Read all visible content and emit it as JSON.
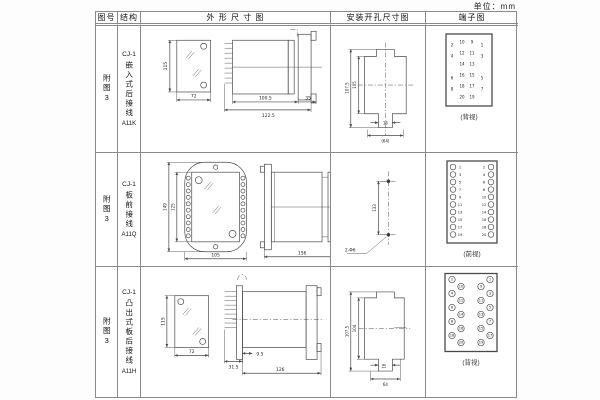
{
  "unit_label": "单位：mm",
  "header": {
    "fig": "图号",
    "structure": "结构",
    "outline": "外 形 尺 寸 图",
    "install": "安装开孔尺寸图",
    "terminal": "端子图"
  },
  "rows": [
    {
      "fig": "附图3",
      "model": "CJ-1",
      "name": "嵌入式后接线",
      "code": "A11K",
      "outline": {
        "front_h": "115",
        "front_w": "72",
        "d1": "100.5",
        "d2": "122.5",
        "d3": "35"
      },
      "install": {
        "outer_h": "107.5",
        "inner_h": "105",
        "slot_w": "16",
        "base_w": "(64)"
      },
      "terminal": {
        "view": "(背视)",
        "nums": [
          "2",
          "10",
          "9",
          "1",
          "4",
          "12",
          "11",
          "3",
          "14",
          "13",
          "6",
          "16",
          "15",
          "5",
          "8",
          "18",
          "17",
          "7",
          "20",
          "19"
        ]
      }
    },
    {
      "fig": "附图3",
      "model": "CJ-1",
      "name": "板前接线",
      "code": "A11Q",
      "outline": {
        "front_h": "149",
        "inner_h": "125",
        "front_w": "105",
        "side_l": "156",
        "side_h": "115"
      },
      "install": {
        "hole_dist": "133",
        "holes": "2-Φ6"
      },
      "terminal": {
        "view": "(前视)",
        "left": [
          "1",
          "3",
          "5",
          "7",
          "9",
          "11",
          "13",
          "15",
          "17",
          "19"
        ],
        "right": [
          "2",
          "4",
          "6",
          "8",
          "10",
          "12",
          "14",
          "16",
          "18",
          "20"
        ]
      }
    },
    {
      "fig": "附图3",
      "model": "CJ-1",
      "name": "凸出式板后接线",
      "code": "A11H",
      "outline": {
        "front_h": "115",
        "front_w": "72",
        "d1": "9.5",
        "d2": "31.5",
        "d3": "126"
      },
      "install": {
        "outer_h": "107.5",
        "inner_h": "104",
        "slot_w": "16",
        "base_w": "64"
      },
      "terminal": {
        "view": "(背视)",
        "nums": [
          "2",
          "1",
          "10",
          "9",
          "4",
          "3",
          "12",
          "11",
          "6",
          "5",
          "14",
          "13",
          "8",
          "7",
          "16",
          "15",
          "18",
          "17",
          "20",
          "19"
        ]
      }
    }
  ]
}
